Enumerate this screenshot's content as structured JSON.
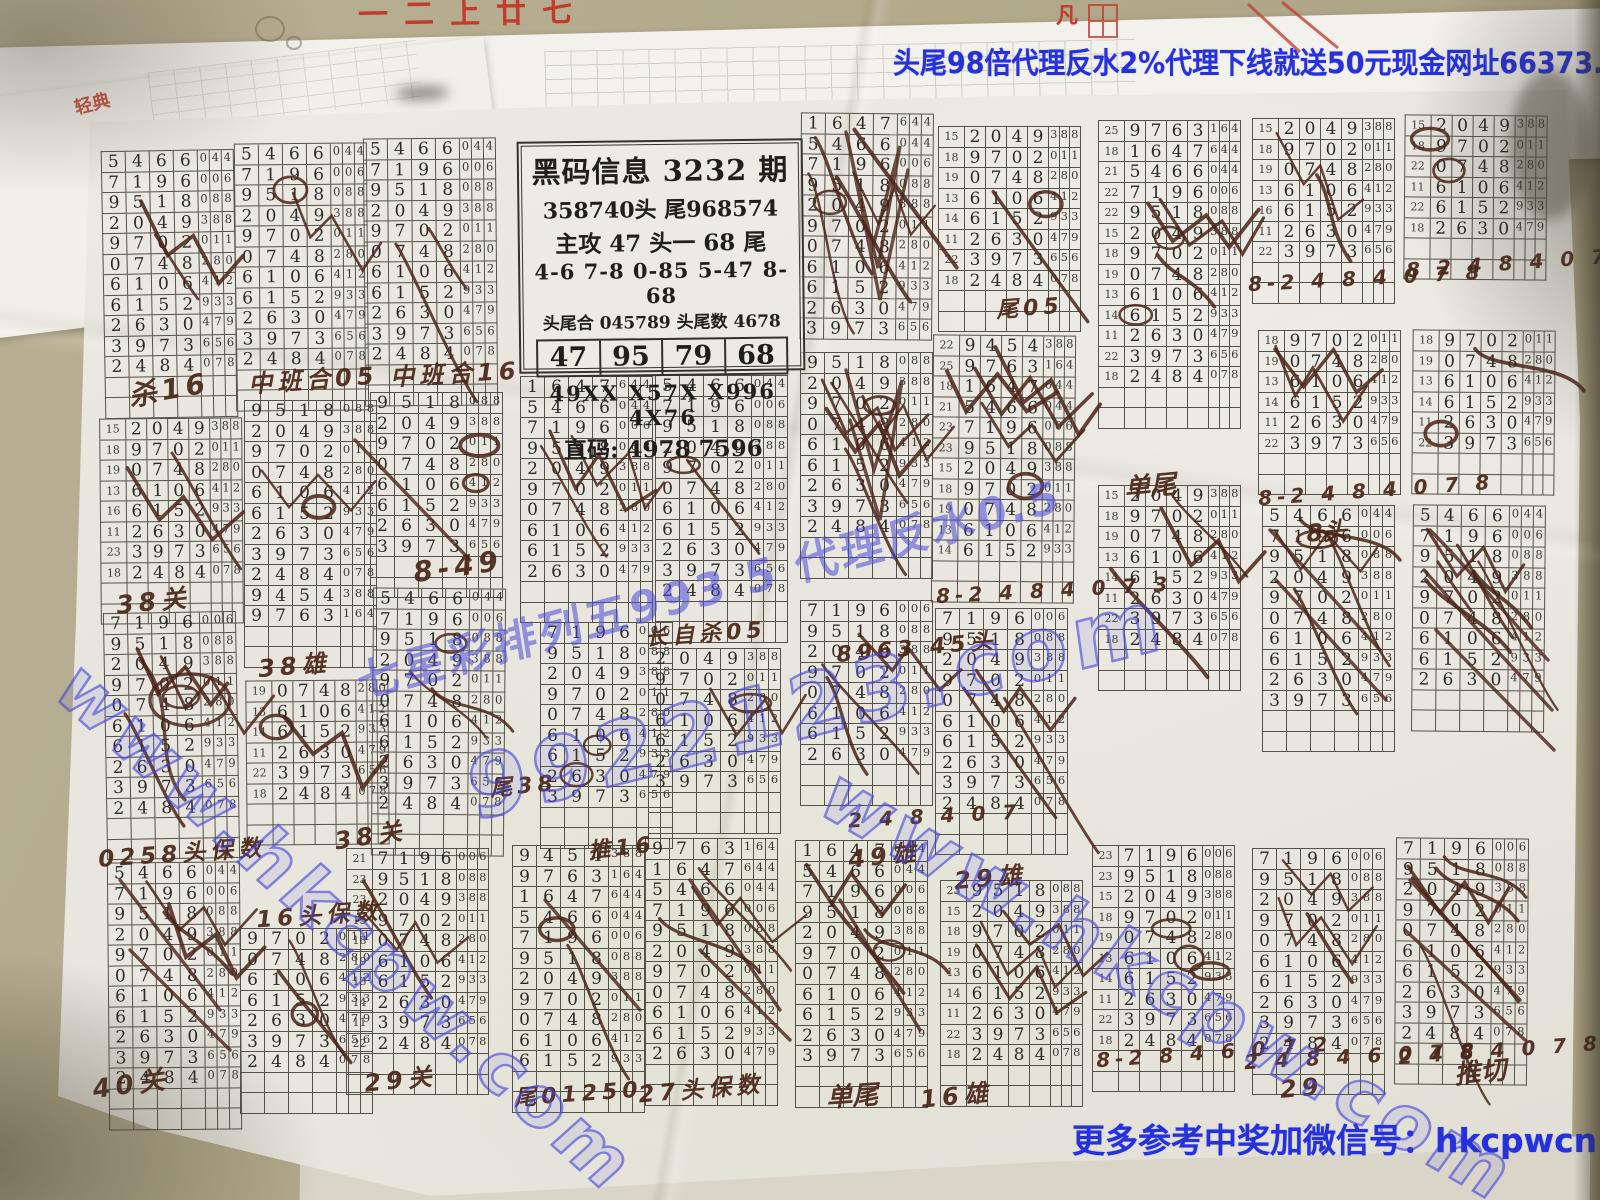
{
  "banners": {
    "top": "头尾98倍代理反水2%代理下线就送50元现金网址66373.com",
    "bottom": "更多参考中奖加微信号：hkcpwcn"
  },
  "info_box": {
    "title": "黑码信息 3232 期",
    "line_head_tail": "358740头   尾968574",
    "line_main": "主攻 47 头一 68 尾",
    "line_pairs": "4-6 7-8 0-85  5-47 8-68",
    "line_sum": "头尾合 045789   头尾数 4678",
    "boxed": [
      "47",
      "95",
      "79",
      "68"
    ],
    "line_codes": "49XX  X57X  X996  4X76",
    "line_direct": "直码: 4978  7596"
  },
  "watermarks": [
    {
      "t": "www.hkcpw.com",
      "x": 100,
      "y": 648,
      "r": 42,
      "s": 72,
      "st": "o"
    },
    {
      "t": "9922123.com",
      "x": 462,
      "y": 742,
      "r": -14,
      "s": 86,
      "st": "o"
    },
    {
      "t": "www.hkcpw.com",
      "x": 855,
      "y": 752,
      "r": 30,
      "s": 76,
      "st": "o"
    },
    {
      "t": "七星彩排列五993 5 代理反水0.5",
      "x": 352,
      "y": 648,
      "r": -15,
      "s": 44,
      "st": "s"
    }
  ],
  "fragments": {
    "seal": "轻典",
    "top_red": "一二上廿七",
    "fan": "凡"
  },
  "rows_master": [
    "9454388",
    "9763164",
    "1647644",
    "5466044",
    "7196006",
    "9518088",
    "2049388",
    "9702011",
    "0748280",
    "6106412",
    "6152933",
    "2630479",
    "3973656",
    "2484078"
  ],
  "grids": [
    {
      "x": 103,
      "y": 150,
      "s": 3,
      "n": 11,
      "m": 2,
      "r": -1
    },
    {
      "x": 235,
      "y": 143,
      "s": 3,
      "n": 11,
      "m": 2,
      "r": -0.5
    },
    {
      "x": 364,
      "y": 138,
      "s": 3,
      "n": 11,
      "m": 2,
      "r": -0.5
    },
    {
      "x": 800,
      "y": 113,
      "s": 2,
      "n": 11,
      "m": 6,
      "r": 0.5,
      "p": 0
    },
    {
      "x": 938,
      "y": 126,
      "s": 6,
      "n": 8,
      "i": [
        15,
        18,
        19,
        13,
        14,
        11,
        22,
        18
      ],
      "m": 2,
      "r": 0
    },
    {
      "x": 932,
      "y": 335,
      "s": 0,
      "n": 11,
      "i": [
        22,
        25,
        18,
        21,
        23,
        23,
        15,
        18,
        19,
        13,
        14
      ],
      "m": 5,
      "r": 0.5
    },
    {
      "x": 1098,
      "y": 120,
      "s": 1,
      "n": 13,
      "i": [
        25,
        18,
        21,
        22,
        22,
        15,
        18,
        19,
        13,
        14,
        11,
        22,
        18
      ],
      "m": 5,
      "r": 0
    },
    {
      "x": 1252,
      "y": 118,
      "s": 6,
      "n": 7,
      "i": [
        15,
        18,
        19,
        13,
        16,
        11,
        22
      ],
      "m": 2,
      "r": 0
    },
    {
      "x": 1404,
      "y": 115,
      "s": 6,
      "n": 6,
      "i": [
        15,
        18,
        22,
        11,
        22,
        18
      ],
      "m": 2,
      "r": 0.5
    },
    {
      "x": 1258,
      "y": 330,
      "s": 7,
      "n": 6,
      "i": [
        18,
        19,
        13,
        14,
        11,
        22
      ],
      "m": 2,
      "r": 0
    },
    {
      "x": 1412,
      "y": 330,
      "s": 7,
      "n": 6,
      "i": [
        18,
        19,
        13,
        14,
        11,
        22
      ],
      "m": 2,
      "r": 0.5
    },
    {
      "x": 100,
      "y": 418,
      "s": 6,
      "n": 8,
      "i": [
        15,
        18,
        19,
        13,
        16,
        11,
        23,
        18
      ],
      "m": 2,
      "r": -0.5
    },
    {
      "x": 105,
      "y": 612,
      "s": 4,
      "n": 10,
      "m": 4,
      "r": -1
    },
    {
      "x": 108,
      "y": 862,
      "s": 3,
      "n": 11,
      "m": 3,
      "r": -0.5
    },
    {
      "x": 244,
      "y": 400,
      "s": 5,
      "n": 11,
      "m": 2,
      "r": 0
    },
    {
      "x": 246,
      "y": 680,
      "s": 8,
      "n": 6,
      "i": [
        19,
        13,
        14,
        11,
        22,
        18
      ],
      "m": 2,
      "r": -0.5
    },
    {
      "x": 240,
      "y": 928,
      "s": 7,
      "n": 7,
      "m": 3,
      "r": 0
    },
    {
      "x": 370,
      "y": 392,
      "s": 5,
      "n": 8,
      "m": 2,
      "r": 0
    },
    {
      "x": 372,
      "y": 588,
      "s": 3,
      "n": 11,
      "m": 3,
      "r": 0.5
    },
    {
      "x": 346,
      "y": 848,
      "s": 4,
      "n": 10,
      "i": [
        21,
        23,
        23,
        15,
        18,
        19,
        13,
        14,
        11,
        22
      ],
      "m": 2,
      "r": 0
    },
    {
      "x": 520,
      "y": 376,
      "s": 2,
      "n": 10,
      "m": 3,
      "r": 0
    },
    {
      "x": 540,
      "y": 622,
      "s": 4,
      "n": 9,
      "m": 2,
      "r": 0
    },
    {
      "x": 512,
      "y": 845,
      "s": 0,
      "n": 11,
      "m": 2,
      "r": 0
    },
    {
      "x": 648,
      "y": 648,
      "s": 6,
      "n": 7,
      "m": 2,
      "r": 0
    },
    {
      "x": 645,
      "y": 838,
      "s": 1,
      "n": 11,
      "m": 3,
      "r": 0
    },
    {
      "x": 795,
      "y": 840,
      "s": 2,
      "n": 11,
      "m": 4,
      "r": 0
    },
    {
      "x": 655,
      "y": 375,
      "s": 3,
      "n": 11,
      "m": 2,
      "r": 0
    },
    {
      "x": 800,
      "y": 352,
      "s": 5,
      "n": 9,
      "m": 6,
      "r": 0
    },
    {
      "x": 935,
      "y": 608,
      "s": 4,
      "n": 10,
      "m": 3,
      "r": 0
    },
    {
      "x": 800,
      "y": 600,
      "s": 4,
      "n": 8,
      "m": 3,
      "r": 0
    },
    {
      "x": 940,
      "y": 880,
      "s": 5,
      "n": 9,
      "i": [
        23,
        15,
        18,
        19,
        13,
        14,
        11,
        22,
        18
      ],
      "m": 3,
      "r": 0
    },
    {
      "x": 1092,
      "y": 845,
      "s": 4,
      "n": 10,
      "i": [
        23,
        23,
        15,
        18,
        19,
        13,
        14,
        11,
        22,
        18
      ],
      "m": 3,
      "r": 0
    },
    {
      "x": 1252,
      "y": 848,
      "s": 4,
      "n": 10,
      "m": 3,
      "r": 0
    },
    {
      "x": 1395,
      "y": 838,
      "s": 4,
      "n": 10,
      "m": 5,
      "r": 0.5
    },
    {
      "x": 1262,
      "y": 505,
      "s": 3,
      "n": 10,
      "m": 5,
      "r": 0
    },
    {
      "x": 1412,
      "y": 505,
      "s": 3,
      "n": 9,
      "m": 6,
      "r": 0.5
    },
    {
      "x": 1098,
      "y": 485,
      "s": 6,
      "n": 8,
      "i": [
        15,
        18,
        19,
        13,
        14,
        11,
        22,
        18
      ],
      "m": 3,
      "r": 0
    }
  ],
  "annotations": [
    {
      "t": "杀16",
      "x": 128,
      "y": 368,
      "s": 28,
      "r": -10
    },
    {
      "t": "中班合05",
      "x": 248,
      "y": 360,
      "s": 24,
      "r": -4
    },
    {
      "t": "中班合16",
      "x": 390,
      "y": 354,
      "s": 24,
      "r": -3
    },
    {
      "t": "8-49",
      "x": 413,
      "y": 550,
      "s": 28,
      "r": -8
    },
    {
      "t": "38关",
      "x": 116,
      "y": 582,
      "s": 25,
      "r": -6
    },
    {
      "t": "0258头保数",
      "x": 98,
      "y": 834,
      "s": 23,
      "r": -4
    },
    {
      "t": "40关",
      "x": 92,
      "y": 1064,
      "s": 26,
      "r": -8
    },
    {
      "t": "38雄",
      "x": 258,
      "y": 646,
      "s": 24,
      "r": -5
    },
    {
      "t": "16头保数",
      "x": 256,
      "y": 896,
      "s": 23,
      "r": -4
    },
    {
      "t": "38关",
      "x": 334,
      "y": 816,
      "s": 24,
      "r": -9
    },
    {
      "t": "29关",
      "x": 364,
      "y": 1060,
      "s": 24,
      "r": -6
    },
    {
      "t": "尾01250",
      "x": 514,
      "y": 1076,
      "s": 22,
      "r": -4
    },
    {
      "t": "27头保数",
      "x": 638,
      "y": 1070,
      "s": 23,
      "r": -5
    },
    {
      "t": "单尾",
      "x": 826,
      "y": 1076,
      "s": 26,
      "r": -4
    },
    {
      "t": "16雄",
      "x": 920,
      "y": 1076,
      "s": 24,
      "r": -6
    },
    {
      "t": "长自杀05",
      "x": 645,
      "y": 616,
      "s": 22,
      "r": -4
    },
    {
      "t": "8963 45头",
      "x": 836,
      "y": 630,
      "s": 22,
      "r": -5
    },
    {
      "t": "单尾",
      "x": 1124,
      "y": 466,
      "s": 26,
      "r": -5
    },
    {
      "t": "29雄",
      "x": 954,
      "y": 858,
      "s": 24,
      "r": -5
    },
    {
      "t": "49雄",
      "x": 848,
      "y": 836,
      "s": 24,
      "r": -6
    },
    {
      "t": "推切",
      "x": 1454,
      "y": 1052,
      "s": 26,
      "r": -6
    },
    {
      "t": "推16",
      "x": 588,
      "y": 830,
      "s": 22,
      "r": -6
    },
    {
      "t": "尾38",
      "x": 490,
      "y": 768,
      "s": 22,
      "r": -5
    },
    {
      "t": "尾05",
      "x": 996,
      "y": 290,
      "s": 22,
      "r": -4
    },
    {
      "t": "8头",
      "x": 1306,
      "y": 512,
      "s": 24,
      "r": -5
    },
    {
      "t": "8-2 4 8 4 0 7 8",
      "x": 1248,
      "y": 266,
      "s": 20,
      "r": -3
    },
    {
      "t": "8 2 4 8 4 0 7 8",
      "x": 1406,
      "y": 250,
      "s": 20,
      "r": -4
    },
    {
      "t": "8-2 4 8 4 0 7 8",
      "x": 1258,
      "y": 478,
      "s": 20,
      "r": -4
    },
    {
      "t": "8-2 4 8 4 0 7 3",
      "x": 936,
      "y": 578,
      "s": 20,
      "r": -3
    },
    {
      "t": "8-2 8 4 6 0 7 2",
      "x": 1096,
      "y": 1040,
      "s": 20,
      "r": -4
    },
    {
      "t": "2 4 8 4 6 0 7 8",
      "x": 1244,
      "y": 1044,
      "s": 20,
      "r": -3
    },
    {
      "t": "29",
      "x": 1280,
      "y": 1074,
      "s": 24,
      "r": -5
    },
    {
      "t": "2 4 8 4 0 7 8",
      "x": 1398,
      "y": 1038,
      "s": 20,
      "r": -4
    },
    {
      "t": "2 4 8 4 0 7",
      "x": 848,
      "y": 804,
      "s": 20,
      "r": -3
    }
  ],
  "colors": {
    "desk": "#b3aa8c",
    "paper": "#e9e7df",
    "line": "#56524a",
    "digit": "#2d2b28",
    "hand": "#4a2517",
    "blue": "#2531dd",
    "red": "#c23b2c"
  }
}
